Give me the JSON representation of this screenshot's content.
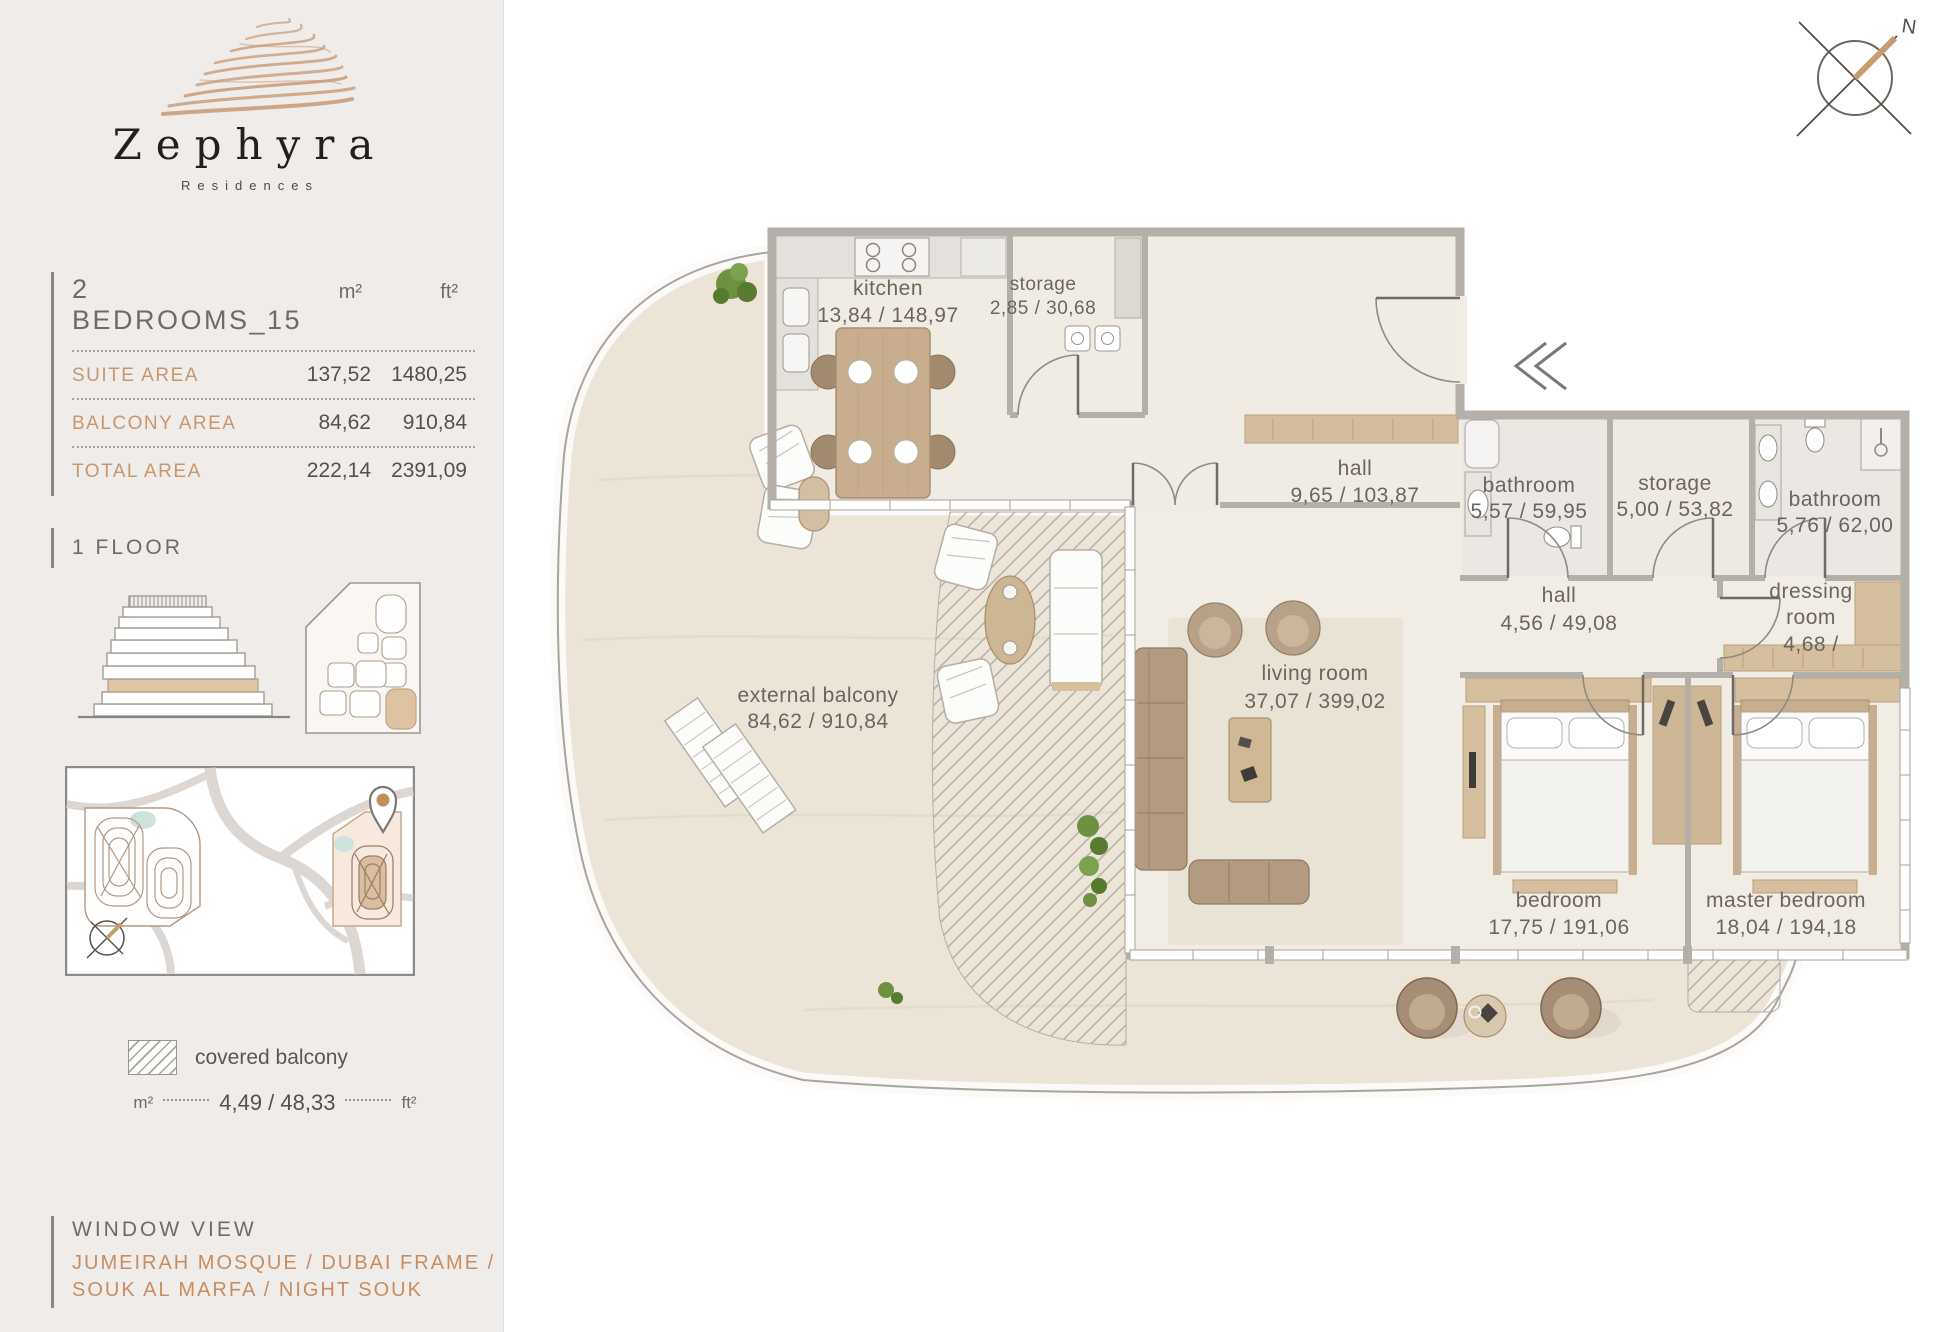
{
  "brand": {
    "name": "Zephyra",
    "subtitle": "Residences"
  },
  "area_table": {
    "title": "2 BEDROOMS_15",
    "unit_m2": "m²",
    "unit_ft2": "ft²",
    "rows": [
      {
        "label": "SUITE AREA",
        "m2": "137,52",
        "ft2": "1480,25"
      },
      {
        "label": "BALCONY AREA",
        "m2": "84,62",
        "ft2": "910,84"
      },
      {
        "label": "TOTAL AREA",
        "m2": "222,14",
        "ft2": "2391,09"
      }
    ]
  },
  "floor_section": {
    "label": "1 FLOOR"
  },
  "legend": {
    "label": "covered balcony",
    "unit_m2": "m²",
    "value": "4,49 / 48,33",
    "unit_ft2": "ft²"
  },
  "window_view": {
    "title": "WINDOW VIEW",
    "line1": "JUMEIRAH MOSQUE / DUBAI FRAME /",
    "line2": "SOUK AL MARFA / NIGHT SOUK"
  },
  "compass": {
    "north": "N"
  },
  "rooms": {
    "kitchen": {
      "name": "kitchen",
      "area": "13,84 / 148,97"
    },
    "storage_top": {
      "name": "storage",
      "area": "2,85 / 30,68"
    },
    "hall_main": {
      "name": "hall",
      "area": "9,65 / 103,87"
    },
    "bathroom_1": {
      "name": "bathroom",
      "area": "5,57 / 59,95"
    },
    "storage_inner": {
      "name": "storage",
      "area": "5,00 / 53,82"
    },
    "bathroom_2": {
      "name": "bathroom",
      "area": "5,76 / 62,00"
    },
    "hall_bedrooms": {
      "name": "hall",
      "area": "4,56 / 49,08"
    },
    "dressing_room": {
      "name_line1": "dressing",
      "name_line2": "room",
      "area": "4,68 /"
    },
    "living_room": {
      "name": "living room",
      "area": "37,07 / 399,02"
    },
    "bedroom": {
      "name": "bedroom",
      "area": "17,75 / 191,06"
    },
    "master_bedroom": {
      "name": "master bedroom",
      "area": "18,04 / 194,18"
    },
    "external_balcony": {
      "name": "external balcony",
      "area": "84,62 / 910,84"
    }
  },
  "colors": {
    "accent_tan": "#c6976f",
    "text_dark": "#55504b",
    "text_gray": "#6f6a65",
    "wall": "#b4afa8",
    "floor": "#f2ede4",
    "balcony_floor": "#ece4d7",
    "wood": "#d5bf9f",
    "highlight_floor": "#dfc5a4"
  }
}
